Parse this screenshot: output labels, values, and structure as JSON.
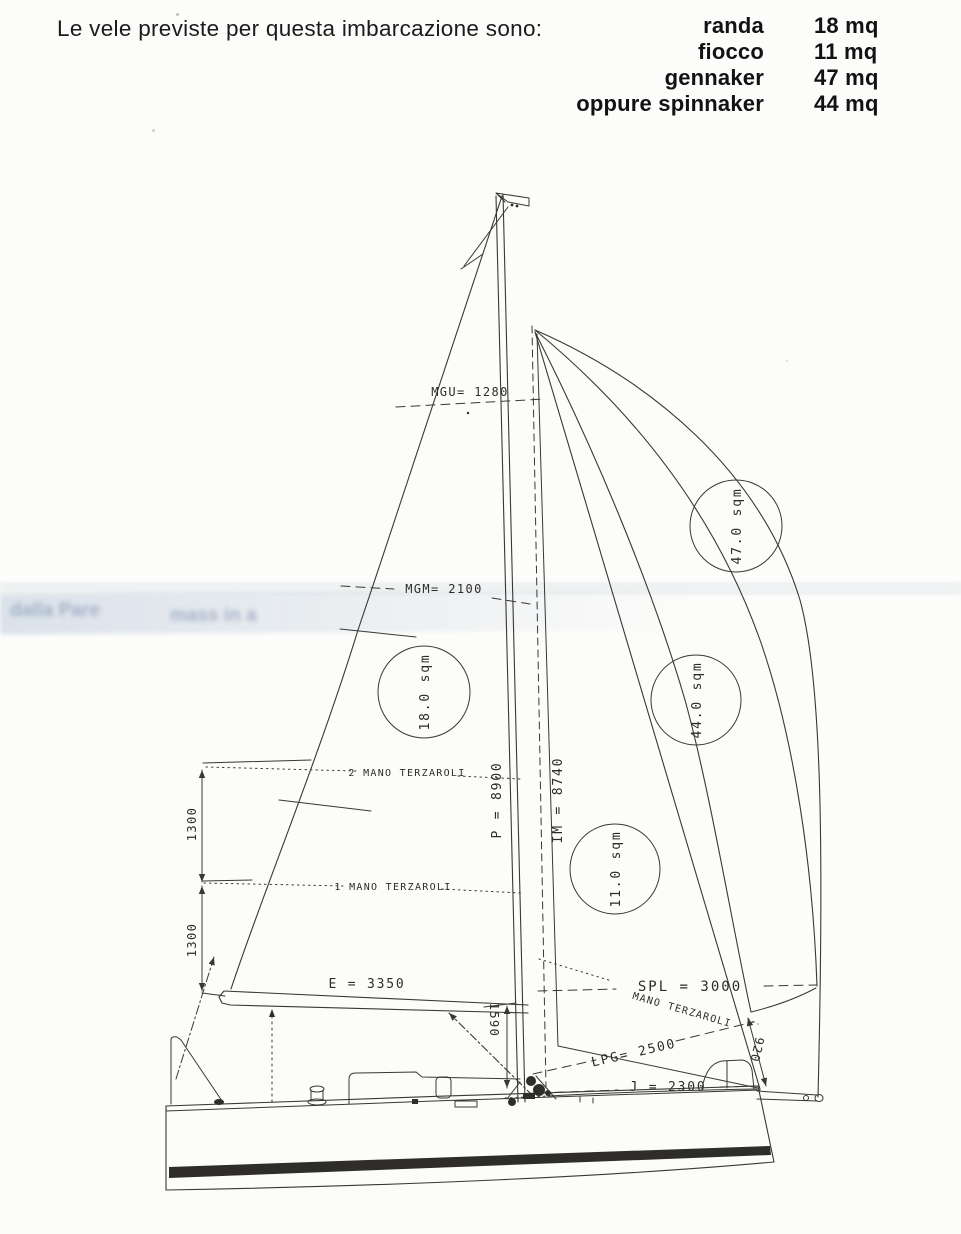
{
  "header": {
    "intro": "Le vele previste per questa imbarcazione sono:",
    "sails": [
      {
        "name": "randa",
        "area": "18 mq"
      },
      {
        "name": "fiocco",
        "area": "11 mq"
      },
      {
        "name": "gennaker",
        "area": "47 mq"
      },
      {
        "name": "oppure spinnaker",
        "area": "44 mq"
      }
    ]
  },
  "diagram": {
    "labels": {
      "mgu": "MGU= 1280",
      "mgm": "MGM= 2100",
      "mainsail_area": "18.0 sqm",
      "gennaker_area": "47.0 sqm",
      "spinnaker_area": "44.0 sqm",
      "jib_area": "11.0 sqm",
      "p": "P = 8900",
      "im": "IM = 8740",
      "reef2": "2 MANO TERZAROLI",
      "reef1": "1 MANO TERZAROLI",
      "mano": "MANO TERZAROLI",
      "dim1300a": "1300",
      "dim1300b": "1300",
      "e": "E = 3350",
      "spl": "SPL = 3000",
      "lpg": "LPG= 2500",
      "j": "J = 2300",
      "dim1590": "1590",
      "dim920": "920"
    },
    "watermark": [
      "dalla Pare",
      "mass in a"
    ]
  },
  "colors": {
    "ink": "#35322f",
    "paper": "#fcfcfa",
    "artifact": "#8ea5c8"
  }
}
